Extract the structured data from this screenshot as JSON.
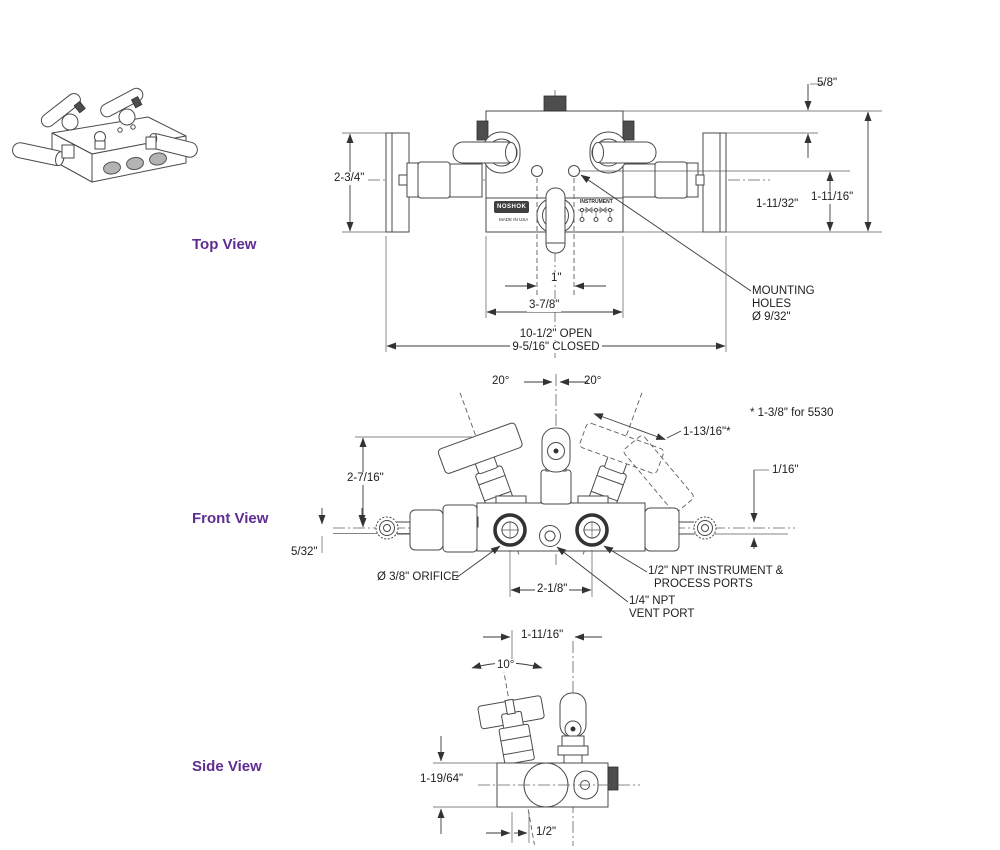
{
  "colors": {
    "accent_purple": "#5f2d91",
    "line": "#4a4a4a"
  },
  "views": {
    "top": {
      "label": "Top View",
      "dims": {
        "body_depth": "2-3/4\"",
        "edge_offset": "5/8\"",
        "hole_to_edge": "1-11/32\"",
        "hole_to_front": "1-11/16\"",
        "hole_spacing_small": "1\"",
        "hole_spacing_large": "3-7/8\"",
        "overall_open": "10-1/2\" OPEN",
        "overall_closed": "9-5/16\" CLOSED"
      },
      "callouts": {
        "mounting_1": "MOUNTING",
        "mounting_2": "HOLES",
        "mounting_3": "Ø 9/32\""
      },
      "branding": {
        "logo": "NOSHOK",
        "origin": "MADE IN USA",
        "port_label": "INSTRUMENT"
      }
    },
    "front": {
      "label": "Front View",
      "dims": {
        "angle_left": "20°",
        "angle_right": "20°",
        "note": "* 1-3/8\" for 5530",
        "handle_length": "1-13/16\"*",
        "handle_height": "2-7/16\"",
        "right_offset": "1/16\"",
        "left_offset": "5/32\"",
        "port_spacing": "2-1/8\""
      },
      "callouts": {
        "orifice": "Ø 3/8\" ORIFICE",
        "ports_1": "1/2\" NPT INSTRUMENT &",
        "ports_2": "PROCESS PORTS",
        "vent_1": "1/4\" NPT",
        "vent_2": "VENT PORT"
      }
    },
    "side": {
      "label": "Side View",
      "dims": {
        "valve_spacing": "1-11/16\"",
        "angle": "10°",
        "body_height": "1-19/64\"",
        "axis_offset": "1/2\""
      }
    }
  }
}
